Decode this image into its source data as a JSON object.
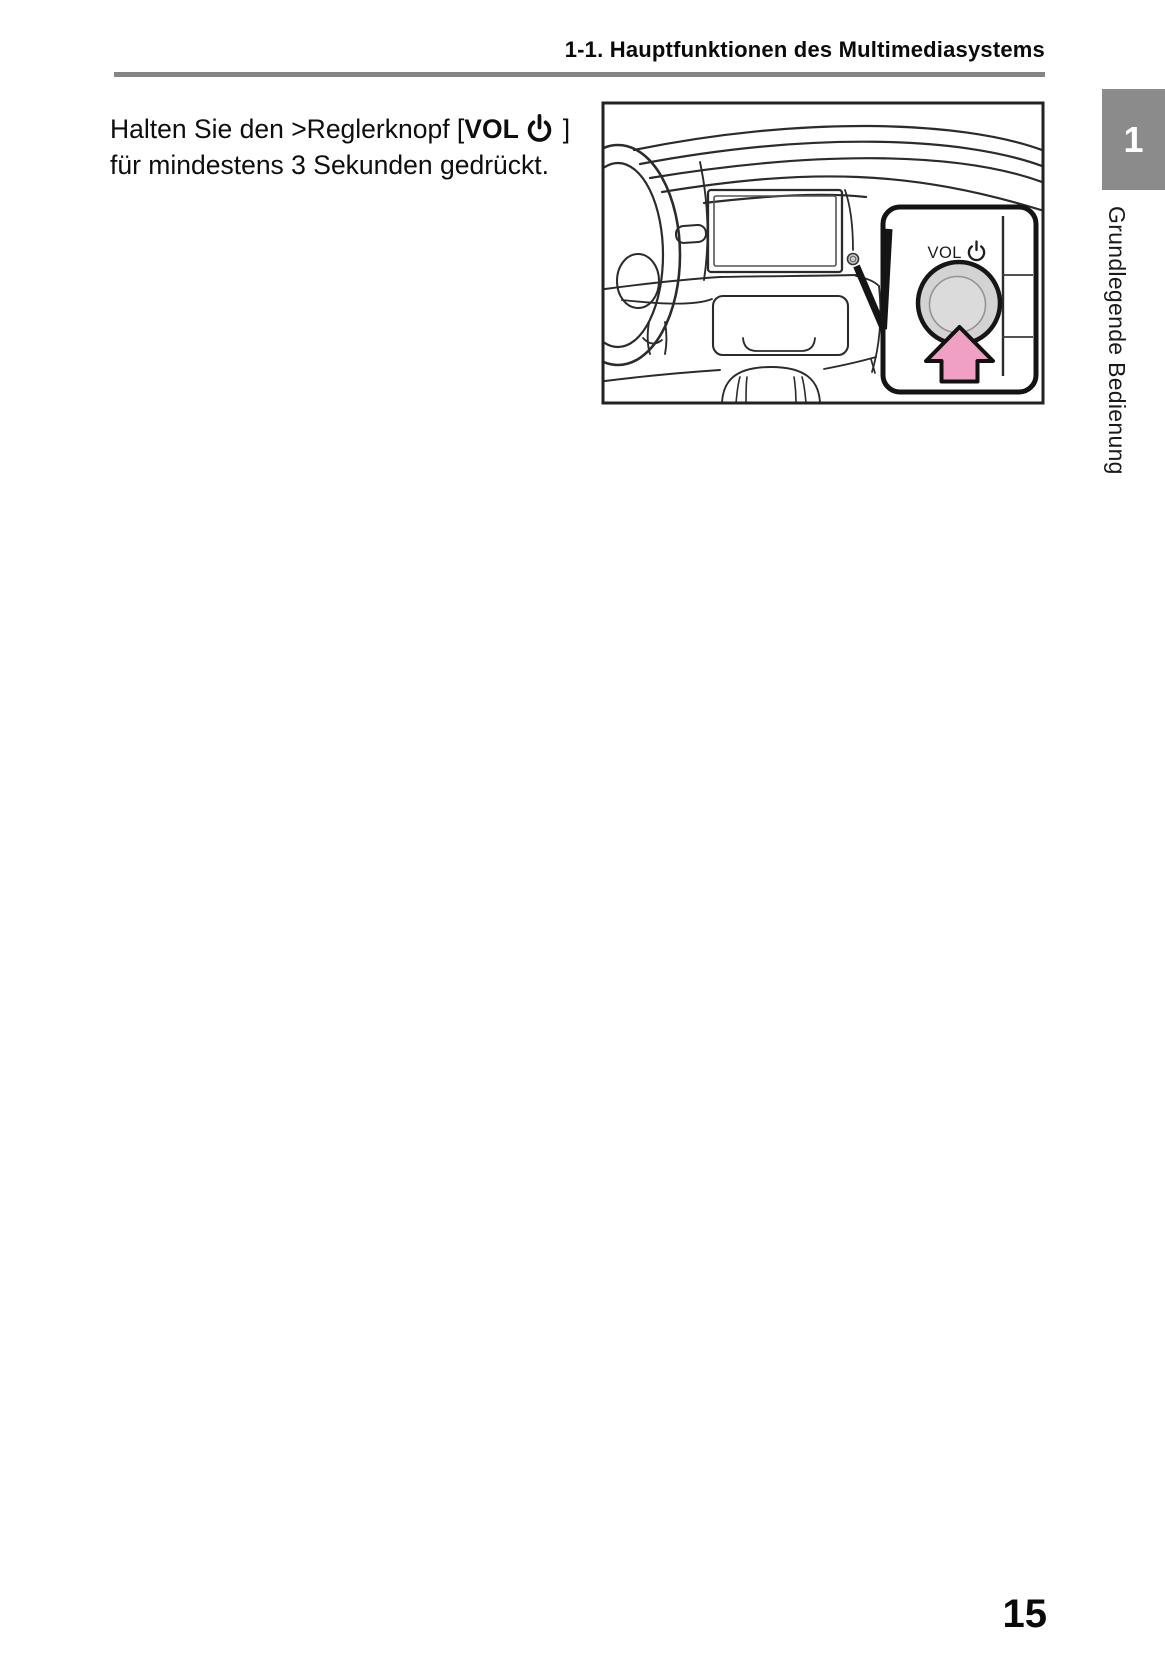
{
  "page": {
    "header_title": "1-1. Hauptfunktionen des Multimediasystems",
    "page_number": "15",
    "rule_color": "#858585"
  },
  "sidebar": {
    "chapter_tab_number": "1",
    "chapter_tab_color": "#8B8B8B",
    "chapter_title_vertical": "Grundlegende Bedienung"
  },
  "instruction": {
    "line1_pre": "Halten Sie den >Reglerknopf [",
    "line1_button": "VOL",
    "line1_post": "]",
    "line2": "für mindestens 3 Sekunden gedrückt."
  },
  "figure": {
    "inset_knob_label": "VOL",
    "arrow_color": "#EFA0C3",
    "knob_fill": "#D3D3D3",
    "knob_inner_fill": "#DBDBDB",
    "line_color": "#2b2b2b"
  }
}
